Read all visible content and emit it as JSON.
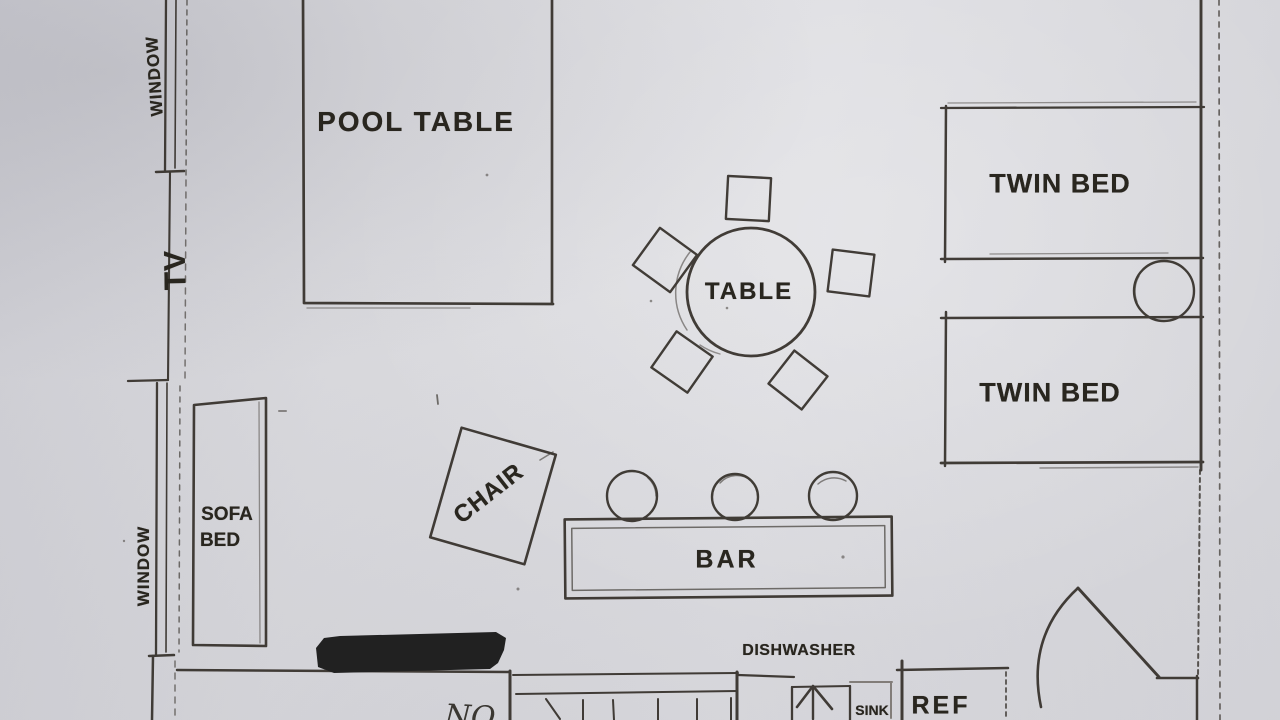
{
  "plan": {
    "description": "hand-drawn apartment floor plan sketch",
    "colors": {
      "paper": "#d8d8dc",
      "ink": "#2f2a24",
      "redaction_bar": "#141414"
    },
    "labels": {
      "window_top": "WINDOW",
      "tv": "TV",
      "window_bottom": "WINDOW",
      "pool_table": "POOL TABLE",
      "table": "TABLE",
      "chair": "CHAIR",
      "bar": "BAR",
      "sofa_line1": "SOFA",
      "sofa_line2": "BED",
      "twin_bed_top": "TWIN BED",
      "twin_bed_bottom": "TWIN BED",
      "dishwasher": "DISHWASHER",
      "sink": "SINK",
      "ref": "REF",
      "handwritten_note": "NO"
    },
    "furniture_counts": {
      "dining_chairs": 5,
      "bar_stools": 3,
      "twin_beds": 2
    }
  }
}
